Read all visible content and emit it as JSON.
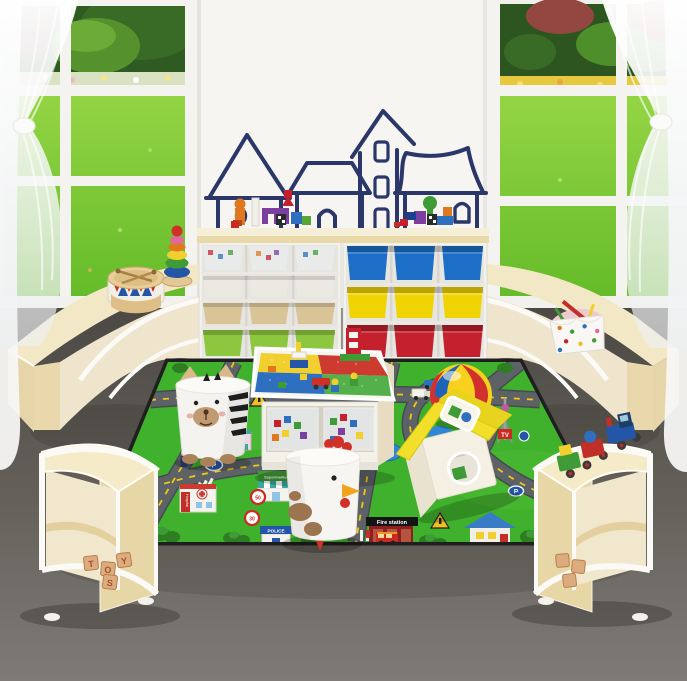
{
  "scene": {
    "alt": "Children's playroom furniture set: two storage shelves with colored bins, curved wooden counters and quarter-round shelves, activity block table, animal stools, house sorter, beach ball and a city road play mat, in front of windows with a garden view and a whiteboard wall with house doodles."
  },
  "labels": {
    "supermarket": "Supermarket",
    "fire_station": "Fire station",
    "police": "POLICE",
    "bank": "BANK",
    "hospital": "Hospital",
    "tv": "TV",
    "parking": "P",
    "speed_50": "50",
    "speed_30": "30"
  },
  "toys_blocks": [
    "T",
    "O",
    "Y",
    "S"
  ],
  "colors": {
    "wall_panel": "#f6f5f1",
    "drawing_navy": "#2a3768",
    "lawn": "#7cc93c",
    "floor_top": "#514d49",
    "floor_bottom": "#7e7a76",
    "wood_light": "#f3e8c6",
    "wood_mid": "#e9d8ab",
    "frame_white": "#f4f3ef",
    "bin_blue": "#1d6ec6",
    "bin_yellow": "#efd303",
    "bin_red": "#c5202e",
    "bin_green": "#8dc63f",
    "bin_tan": "#d9c498",
    "bin_white": "#ebe9e1",
    "bin_clear": "#e9ecea",
    "mat_green": "#3fb12c",
    "road_gray": "#5d6267",
    "dash_yellow": "#f3c613",
    "ball_blue": "#1f63b8",
    "ball_yellow": "#f7d11e",
    "ball_red": "#d2302c",
    "roof_yellow": "#f2df2a"
  }
}
